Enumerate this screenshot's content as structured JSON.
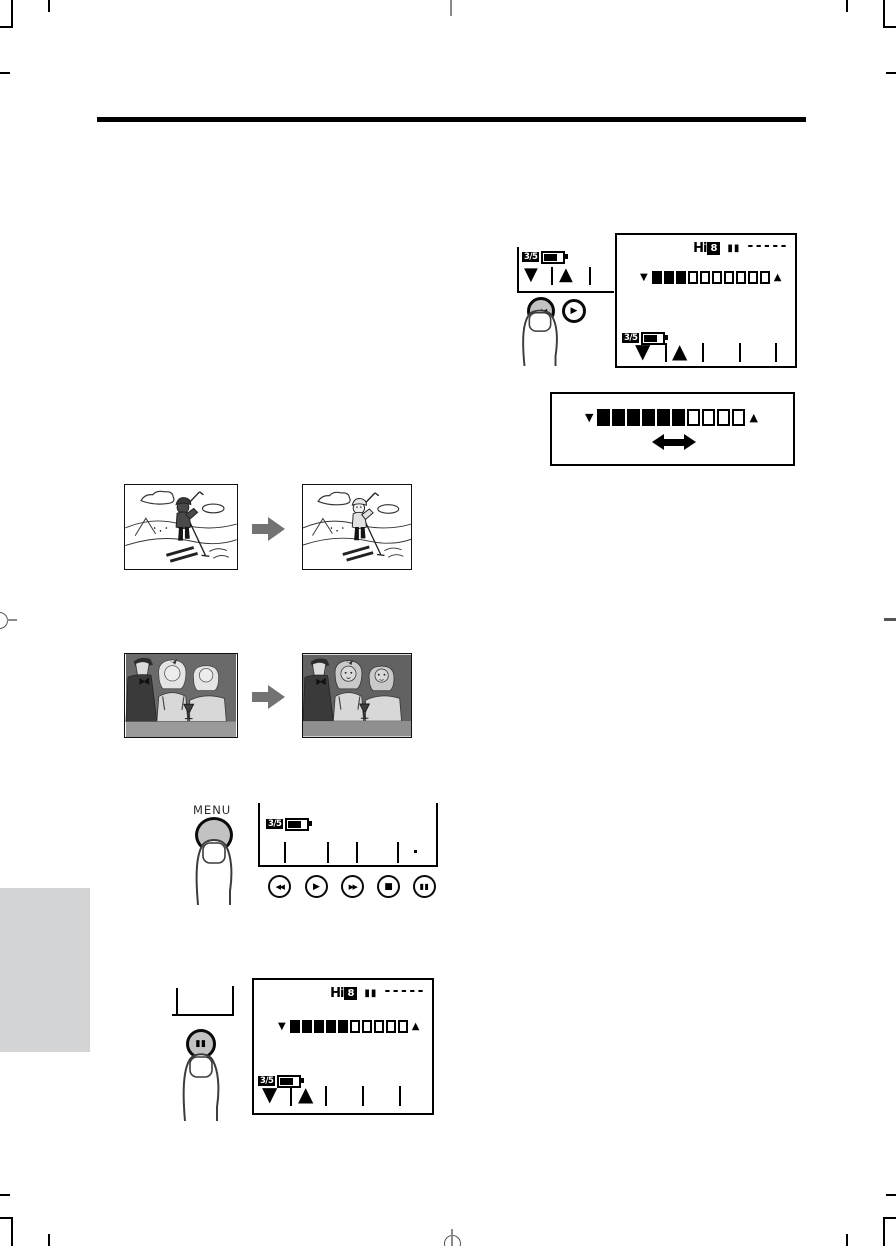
{
  "page": {
    "type": "camcorder manual page (figures only)",
    "accent_black": "#000000",
    "button_gray": "#c2c2c2",
    "tab_gray": "#d2d4d6",
    "arrow_gray": "#737373"
  },
  "labels": {
    "menu": "MENU",
    "battery": "3/5",
    "hi8_prefix": "Hi",
    "hi8_digit": "8",
    "pause_indicator": "▮▮",
    "tape_dashes": "-----"
  },
  "controls": {
    "volume_down": "▼",
    "volume_up": "▲",
    "rewind": "◀◀",
    "play": "▶",
    "fast_forward": "▶▶",
    "stop": "■",
    "pause": "▮▮",
    "left_right_arrow": "↔",
    "next_step_arrow": "➡"
  },
  "meters": {
    "lcd_top": {
      "filled": 3,
      "empty": 7
    },
    "adjust_box": {
      "filled": 6,
      "empty": 4
    },
    "lcd_bottom": {
      "filled": 5,
      "empty": 5
    }
  },
  "playback_buttons": [
    {
      "name": "rewind",
      "glyph": "◀◀"
    },
    {
      "name": "play",
      "glyph": "▶"
    },
    {
      "name": "fast-forward",
      "glyph": "▶▶"
    },
    {
      "name": "stop",
      "glyph": "■"
    },
    {
      "name": "pause",
      "glyph": "▮▮"
    }
  ],
  "icons": {
    "flow_arrow": "right-arrow",
    "double_arrow": "left-right-arrow",
    "finger": "pressing-finger",
    "battery": "battery-level",
    "hi8": "hi8-format-logo"
  }
}
